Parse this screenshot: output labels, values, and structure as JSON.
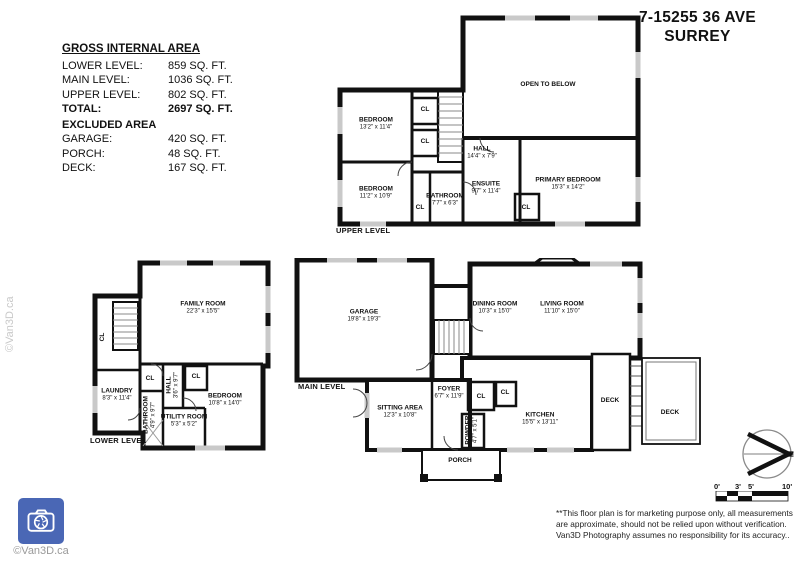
{
  "header": {
    "title_line1": "7-15255 36 AVE",
    "title_line2": "SURREY"
  },
  "area_summary": {
    "heading": "GROSS INTERNAL AREA",
    "rows": [
      {
        "label": "LOWER LEVEL:",
        "value": "859 SQ. FT."
      },
      {
        "label": "MAIN LEVEL:",
        "value": "1036 SQ. FT."
      },
      {
        "label": "UPPER LEVEL:",
        "value": "802 SQ. FT."
      },
      {
        "label": "TOTAL:",
        "value": "2697 SQ. FT.",
        "bold": true
      }
    ],
    "excluded_heading": "EXCLUDED AREA",
    "excluded_rows": [
      {
        "label": "GARAGE:",
        "value": "420 SQ. FT."
      },
      {
        "label": "PORCH:",
        "value": "48 SQ. FT."
      },
      {
        "label": "DECK:",
        "value": "167 SQ. FT."
      }
    ]
  },
  "floors": [
    {
      "id": "upper",
      "label": "UPPER LEVEL",
      "rooms": [
        {
          "name": "OPEN TO BELOW",
          "x": 218,
          "y": 73
        },
        {
          "name": "BEDROOM",
          "dims": "13'2\" x 11'4\"",
          "x": 46,
          "y": 112
        },
        {
          "name": "CL",
          "x": 95,
          "y": 98
        },
        {
          "name": "CL",
          "x": 95,
          "y": 130
        },
        {
          "name": "HALL",
          "dims": "14'4\" x 7'9\"",
          "x": 152,
          "y": 141
        },
        {
          "name": "BEDROOM",
          "dims": "11'2\" x 10'9\"",
          "x": 46,
          "y": 181
        },
        {
          "name": "CL",
          "x": 90,
          "y": 196
        },
        {
          "name": "BATHROOM",
          "dims": "7'7\" x 6'3\"",
          "x": 115,
          "y": 188
        },
        {
          "name": "ENSUITE",
          "dims": "9'7\" x 11'4\"",
          "x": 156,
          "y": 176
        },
        {
          "name": "CL",
          "x": 196,
          "y": 196
        },
        {
          "name": "PRIMARY BEDROOM",
          "dims": "15'3\" x 14'2\"",
          "x": 238,
          "y": 172
        }
      ]
    },
    {
      "id": "lower",
      "label": "LOWER LEVEL",
      "rooms": [
        {
          "name": "FAMILY ROOM",
          "dims": "22'3\" x 15'5\"",
          "x": 118,
          "y": 50
        },
        {
          "name": "CL",
          "x": 18,
          "y": 79,
          "vertical": true
        },
        {
          "name": "LAUNDRY",
          "dims": "8'3\" x 11'4\"",
          "x": 32,
          "y": 137
        },
        {
          "name": "CL",
          "x": 65,
          "y": 121
        },
        {
          "name": "BATHROOM",
          "dims": "4'9\" x 9'7\"",
          "x": 65,
          "y": 157,
          "vertical": true
        },
        {
          "name": "HALL",
          "dims": "3'6\" x 9'7\"",
          "x": 88,
          "y": 127,
          "vertical": true
        },
        {
          "name": "UTILITY ROOM",
          "dims": "5'3\" x 5'2\"",
          "x": 99,
          "y": 163
        },
        {
          "name": "CL",
          "x": 111,
          "y": 119
        },
        {
          "name": "BEDROOM",
          "dims": "10'8\" x 14'0\"",
          "x": 140,
          "y": 142
        }
      ]
    },
    {
      "id": "main",
      "label": "MAIN LEVEL",
      "rooms": [
        {
          "name": "GARAGE",
          "dims": "19'8\" x 19'3\"",
          "x": 92,
          "y": 58
        },
        {
          "name": "DINING ROOM",
          "dims": "10'3\" x 15'0\"",
          "x": 223,
          "y": 50
        },
        {
          "name": "LIVING ROOM",
          "dims": "11'10\" x 15'0\"",
          "x": 290,
          "y": 50
        },
        {
          "name": "SITTING AREA",
          "dims": "12'3\" x 10'8\"",
          "x": 128,
          "y": 154
        },
        {
          "name": "FOYER",
          "dims": "6'7\" x 11'9\"",
          "x": 177,
          "y": 135
        },
        {
          "name": "CL",
          "x": 209,
          "y": 139
        },
        {
          "name": "CL",
          "x": 233,
          "y": 135
        },
        {
          "name": "POWDER",
          "dims": "4'7\" x 5'1\"",
          "x": 200,
          "y": 172,
          "vertical": true
        },
        {
          "name": "KITCHEN",
          "dims": "15'5\" x 13'11\"",
          "x": 268,
          "y": 161
        },
        {
          "name": "DECK",
          "x": 338,
          "y": 143
        },
        {
          "name": "DECK",
          "x": 398,
          "y": 155
        },
        {
          "name": "PORCH",
          "x": 188,
          "y": 203
        }
      ]
    }
  ],
  "scale_bar": {
    "ticks": [
      "0'",
      "3'",
      "5'",
      "10'"
    ]
  },
  "compass": {
    "north_label": "N"
  },
  "disclaimer": "**This floor plan is for marketing purpose only, all measurements are approximate, should not be relied upon without verification. Van3D Photography assumes no responsibility for its accuracy..",
  "branding": {
    "watermark": "©Van3D.ca",
    "logo_caption": "©Van3D.ca"
  }
}
